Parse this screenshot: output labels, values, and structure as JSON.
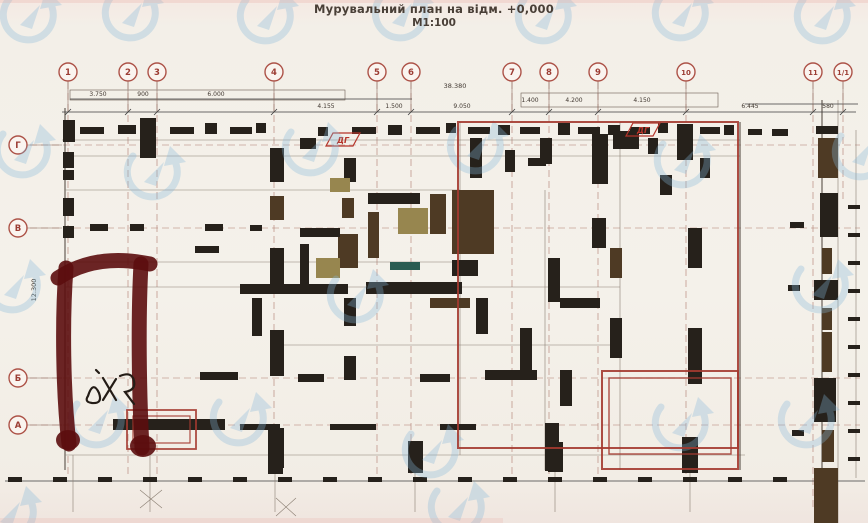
{
  "title": {
    "line1": "Мурувальний план на відм. +0,000",
    "line2": "М1:100"
  },
  "axes": {
    "bubble_color": "#ad5348",
    "top_row_y": 72,
    "top": [
      {
        "label": "1",
        "x": 68
      },
      {
        "label": "2",
        "x": 128
      },
      {
        "label": "3",
        "x": 157
      },
      {
        "label": "4",
        "x": 274
      },
      {
        "label": "5",
        "x": 377
      },
      {
        "label": "6",
        "x": 411
      },
      {
        "label": "7",
        "x": 512
      },
      {
        "label": "8",
        "x": 549
      },
      {
        "label": "9",
        "x": 598
      },
      {
        "label": "10",
        "x": 686
      },
      {
        "label": "11",
        "x": 813,
        "drop": 510
      },
      {
        "label": "1/1",
        "x": 843,
        "drop": 200
      }
    ],
    "left_col_x": 18,
    "left": [
      {
        "label": "Г",
        "y": 145
      },
      {
        "label": "В",
        "y": 228
      },
      {
        "label": "Б",
        "y": 378
      },
      {
        "label": "А",
        "y": 425
      }
    ]
  },
  "dimensions": {
    "overall_top": {
      "text": "38.380",
      "x": 455,
      "y": 88
    },
    "left_vertical": {
      "text": "12.300",
      "x": 36,
      "y": 290
    },
    "segments": [
      {
        "text": "3.750",
        "x": 98,
        "y": 96
      },
      {
        "text": "900",
        "x": 143,
        "y": 96
      },
      {
        "text": "6.000",
        "x": 216,
        "y": 96
      },
      {
        "text": "4.155",
        "x": 326,
        "y": 108
      },
      {
        "text": "1.500",
        "x": 394,
        "y": 108
      },
      {
        "text": "9.050",
        "x": 462,
        "y": 108
      },
      {
        "text": "1.400",
        "x": 530,
        "y": 102
      },
      {
        "text": "4.200",
        "x": 574,
        "y": 102
      },
      {
        "text": "4.150",
        "x": 642,
        "y": 102
      },
      {
        "text": "6.445",
        "x": 750,
        "y": 108
      },
      {
        "text": "580",
        "x": 828,
        "y": 108
      }
    ],
    "boxes": [
      [
        70,
        90,
        275,
        10
      ],
      [
        521,
        93,
        197,
        14
      ]
    ]
  },
  "flags": {
    "label": "ДГ",
    "color": "#b5342a",
    "positions": [
      {
        "x": 326,
        "y": 133
      },
      {
        "x": 626,
        "y": 123
      }
    ]
  },
  "plan": {
    "colors": {
      "0": "#26211b",
      "1": "#4e3a24",
      "2": "#97864f",
      "3": "#2a5c52"
    },
    "walls": [
      [
        63,
        120,
        12,
        22,
        0
      ],
      [
        80,
        127,
        24,
        7,
        0
      ],
      [
        118,
        125,
        18,
        9,
        0
      ],
      [
        140,
        118,
        16,
        40,
        0
      ],
      [
        170,
        127,
        24,
        7,
        0
      ],
      [
        205,
        123,
        12,
        11,
        0
      ],
      [
        230,
        127,
        22,
        7,
        0
      ],
      [
        256,
        123,
        10,
        10,
        0
      ],
      [
        300,
        138,
        16,
        11,
        0
      ],
      [
        318,
        127,
        10,
        9,
        0
      ],
      [
        352,
        127,
        24,
        7,
        0
      ],
      [
        388,
        125,
        14,
        10,
        0
      ],
      [
        416,
        127,
        24,
        7,
        0
      ],
      [
        446,
        123,
        10,
        10,
        0
      ],
      [
        468,
        127,
        22,
        7,
        0
      ],
      [
        498,
        125,
        12,
        10,
        0
      ],
      [
        520,
        127,
        20,
        7,
        0
      ],
      [
        558,
        123,
        12,
        12,
        0
      ],
      [
        578,
        127,
        22,
        7,
        0
      ],
      [
        608,
        125,
        12,
        10,
        0
      ],
      [
        630,
        127,
        20,
        7,
        0
      ],
      [
        658,
        123,
        10,
        10,
        0
      ],
      [
        677,
        124,
        16,
        36,
        0
      ],
      [
        700,
        127,
        20,
        7,
        0
      ],
      [
        724,
        125,
        10,
        10,
        0
      ],
      [
        63,
        152,
        11,
        16,
        0
      ],
      [
        63,
        170,
        11,
        10,
        0
      ],
      [
        63,
        198,
        11,
        18,
        0
      ],
      [
        63,
        226,
        11,
        12,
        0
      ],
      [
        195,
        246,
        24,
        7,
        0
      ],
      [
        270,
        148,
        14,
        34,
        0
      ],
      [
        270,
        196,
        14,
        24,
        1
      ],
      [
        270,
        248,
        14,
        38,
        0
      ],
      [
        270,
        330,
        14,
        46,
        0
      ],
      [
        268,
        428,
        16,
        40,
        0
      ],
      [
        344,
        158,
        12,
        24,
        0
      ],
      [
        330,
        178,
        20,
        14,
        2
      ],
      [
        342,
        198,
        12,
        20,
        1
      ],
      [
        338,
        234,
        20,
        34,
        1
      ],
      [
        344,
        298,
        12,
        28,
        0
      ],
      [
        344,
        356,
        12,
        24,
        0
      ],
      [
        368,
        193,
        52,
        11,
        0
      ],
      [
        368,
        212,
        11,
        46,
        1
      ],
      [
        398,
        208,
        30,
        26,
        2
      ],
      [
        430,
        194,
        16,
        40,
        1
      ],
      [
        452,
        190,
        42,
        64,
        1
      ],
      [
        452,
        260,
        26,
        16,
        0
      ],
      [
        390,
        262,
        30,
        8,
        3
      ],
      [
        366,
        282,
        96,
        12,
        0
      ],
      [
        430,
        298,
        40,
        10,
        1
      ],
      [
        476,
        298,
        12,
        36,
        0
      ],
      [
        300,
        228,
        40,
        9,
        0
      ],
      [
        300,
        244,
        9,
        40,
        0
      ],
      [
        316,
        258,
        24,
        20,
        2
      ],
      [
        240,
        284,
        108,
        10,
        0
      ],
      [
        252,
        298,
        10,
        38,
        0
      ],
      [
        90,
        224,
        18,
        7,
        0
      ],
      [
        130,
        224,
        14,
        7,
        0
      ],
      [
        205,
        224,
        18,
        7,
        0
      ],
      [
        250,
        225,
        12,
        6,
        0
      ],
      [
        470,
        138,
        12,
        40,
        0
      ],
      [
        505,
        150,
        10,
        22,
        0
      ],
      [
        528,
        158,
        18,
        8,
        0
      ],
      [
        540,
        138,
        12,
        26,
        0
      ],
      [
        592,
        134,
        16,
        50,
        0
      ],
      [
        613,
        131,
        26,
        18,
        0
      ],
      [
        648,
        138,
        10,
        16,
        0
      ],
      [
        660,
        175,
        12,
        20,
        0
      ],
      [
        700,
        158,
        10,
        20,
        0
      ],
      [
        592,
        218,
        14,
        30,
        0
      ],
      [
        548,
        258,
        12,
        44,
        0
      ],
      [
        610,
        248,
        12,
        30,
        1
      ],
      [
        560,
        298,
        40,
        10,
        0
      ],
      [
        610,
        318,
        12,
        40,
        0
      ],
      [
        688,
        228,
        14,
        40,
        0
      ],
      [
        688,
        328,
        14,
        56,
        0
      ],
      [
        520,
        328,
        12,
        44,
        0
      ],
      [
        485,
        370,
        52,
        10,
        0
      ],
      [
        560,
        370,
        12,
        36,
        0
      ],
      [
        545,
        423,
        14,
        48,
        0
      ],
      [
        200,
        372,
        38,
        8,
        0
      ],
      [
        298,
        374,
        26,
        8,
        0
      ],
      [
        420,
        374,
        30,
        8,
        0
      ],
      [
        113,
        419,
        112,
        11,
        0
      ],
      [
        240,
        424,
        40,
        6,
        0
      ],
      [
        330,
        424,
        46,
        6,
        0
      ],
      [
        440,
        424,
        36,
        6,
        0
      ],
      [
        268,
        440,
        15,
        34,
        0
      ],
      [
        408,
        441,
        15,
        32,
        0
      ],
      [
        548,
        442,
        15,
        30,
        0
      ],
      [
        682,
        437,
        16,
        36,
        0
      ],
      [
        748,
        129,
        14,
        6,
        0
      ],
      [
        772,
        129,
        16,
        7,
        0
      ],
      [
        816,
        126,
        22,
        8,
        0
      ],
      [
        818,
        138,
        20,
        40,
        1
      ],
      [
        820,
        193,
        18,
        44,
        0
      ],
      [
        822,
        248,
        10,
        26,
        1
      ],
      [
        814,
        280,
        24,
        20,
        0
      ],
      [
        822,
        308,
        10,
        22,
        1
      ],
      [
        822,
        332,
        10,
        40,
        1
      ],
      [
        814,
        378,
        22,
        44,
        0
      ],
      [
        822,
        430,
        12,
        32,
        1
      ],
      [
        814,
        468,
        24,
        55,
        1
      ],
      [
        790,
        222,
        14,
        6,
        0
      ],
      [
        788,
        285,
        12,
        6,
        0
      ],
      [
        792,
        430,
        12,
        6,
        0
      ]
    ],
    "lines": [
      [
        65,
        108,
        65,
        470,
        "w"
      ],
      [
        62,
        140,
        740,
        140,
        "l"
      ],
      [
        68,
        156,
        740,
        156,
        "l"
      ],
      [
        65,
        190,
        460,
        190,
        "l"
      ],
      [
        65,
        262,
        460,
        262,
        "l"
      ],
      [
        65,
        287,
        620,
        287,
        "l"
      ],
      [
        270,
        345,
        620,
        345,
        "l"
      ],
      [
        65,
        455,
        745,
        455,
        "l"
      ],
      [
        460,
        122,
        460,
        455,
        "l"
      ],
      [
        545,
        190,
        545,
        470,
        "l"
      ],
      [
        620,
        122,
        620,
        470,
        "l"
      ],
      [
        740,
        122,
        740,
        470,
        "w"
      ],
      [
        822,
        100,
        822,
        523,
        "w"
      ],
      [
        838,
        100,
        838,
        523,
        "l"
      ],
      [
        745,
        104,
        858,
        104,
        "d"
      ],
      [
        856,
        130,
        856,
        478,
        "l"
      ],
      [
        62,
        112,
        856,
        112,
        "d"
      ],
      [
        70,
        99,
        412,
        99,
        "d"
      ],
      [
        5,
        481,
        865,
        481,
        "d"
      ],
      [
        73,
        455,
        73,
        512,
        "l"
      ],
      [
        150,
        455,
        150,
        512,
        "l"
      ],
      [
        275,
        470,
        275,
        512,
        "l"
      ],
      [
        415,
        470,
        415,
        512,
        "l"
      ],
      [
        555,
        470,
        555,
        512,
        "l"
      ],
      [
        690,
        470,
        690,
        512,
        "l"
      ],
      [
        140,
        490,
        162,
        508,
        "l"
      ],
      [
        162,
        490,
        140,
        508,
        "l"
      ],
      [
        276,
        498,
        296,
        516,
        "l"
      ],
      [
        296,
        498,
        276,
        516,
        "l"
      ]
    ],
    "tick_row": {
      "y": 477,
      "x0": 8,
      "step": 45,
      "count": 19,
      "w": 14,
      "h": 5
    },
    "tick_col": {
      "x": 848,
      "y0": 205,
      "step": 28,
      "count": 10,
      "w": 12,
      "h": 4
    }
  },
  "redlines": {
    "color": "#a43a30",
    "rects": [
      [
        458,
        122,
        280,
        326,
        2
      ],
      [
        602,
        371,
        136,
        98,
        2
      ],
      [
        609,
        378,
        122,
        76,
        1.4
      ],
      [
        127,
        410,
        69,
        39,
        1.8
      ],
      [
        133,
        416,
        57,
        27,
        1.2
      ]
    ],
    "p_mark": {
      "color": "#5c0d0e",
      "strokes": [
        "M58,278 C82,262 112,256 150,264",
        "M66,268 C62,320 63,392 69,444",
        "M141,264 C138,318 139,392 142,448"
      ],
      "blobs": [
        [
          68,
          440,
          12,
          10
        ],
        [
          143,
          446,
          13,
          11
        ]
      ]
    },
    "scribble": {
      "color": "#241c16",
      "paths": [
        "M88,396 q5,-16 11,-3 q4,11 -7,10 q-8,-1 -4,-7",
        "M103,378 l13,22",
        "M116,379 l-13,21",
        "M120,376 q12,-5 14,5 q2,9 -9,11 l9,12",
        "M96,370 l3,3"
      ]
    }
  },
  "watermarks": {
    "color": "#85b8d8",
    "opacity": 0.32,
    "positions": [
      [
        28,
        15
      ],
      [
        130,
        13
      ],
      [
        265,
        16
      ],
      [
        400,
        13
      ],
      [
        543,
        16
      ],
      [
        680,
        13
      ],
      [
        822,
        16
      ],
      [
        22,
        150
      ],
      [
        152,
        172
      ],
      [
        310,
        148
      ],
      [
        475,
        146
      ],
      [
        682,
        160
      ],
      [
        860,
        152
      ],
      [
        12,
        285
      ],
      [
        355,
        295
      ],
      [
        820,
        285
      ],
      [
        96,
        420
      ],
      [
        238,
        418
      ],
      [
        430,
        450
      ],
      [
        680,
        423
      ],
      [
        806,
        420
      ],
      [
        8,
        512
      ],
      [
        456,
        507
      ]
    ]
  }
}
